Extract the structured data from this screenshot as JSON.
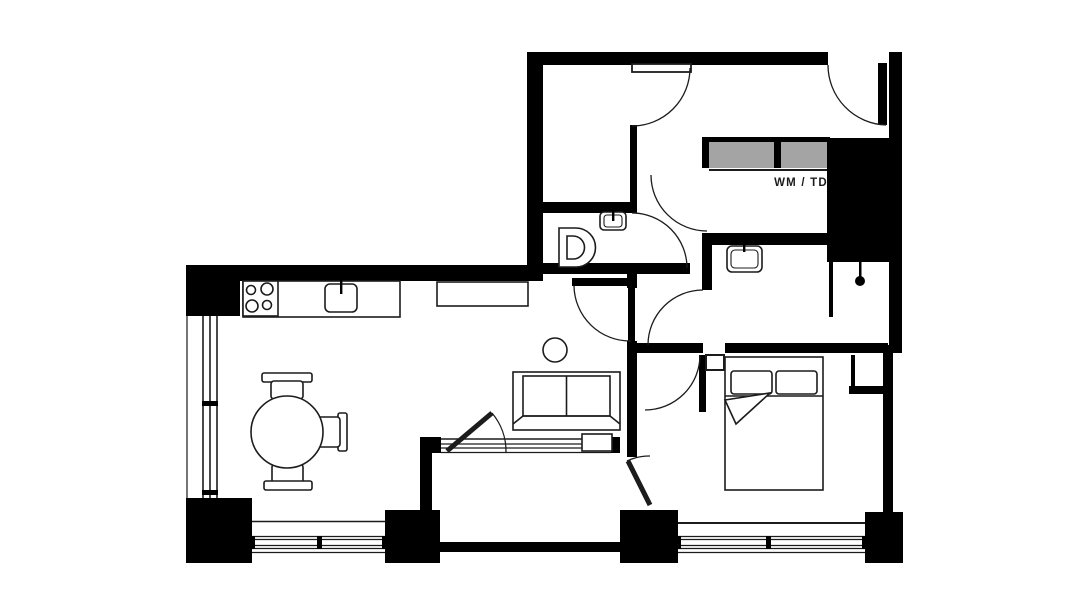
{
  "canvas": {
    "width": 1092,
    "height": 614
  },
  "labels": {
    "wm_td": "WM / TD"
  },
  "colors": {
    "background": "#ffffff",
    "wall": "#000000",
    "line": "#1c1c1c",
    "appliance_gray": "#a4a4a4"
  },
  "symbols": [
    "stove",
    "kitchen-sink",
    "kitchen-counter",
    "sideboard",
    "dining-table",
    "dining-chair",
    "sofa",
    "side-table",
    "double-bed",
    "pillow",
    "toilet",
    "wash-basin",
    "shower-head",
    "shower-screen",
    "washing-machine",
    "tumble-dryer",
    "window",
    "door-swing",
    "balcony"
  ]
}
